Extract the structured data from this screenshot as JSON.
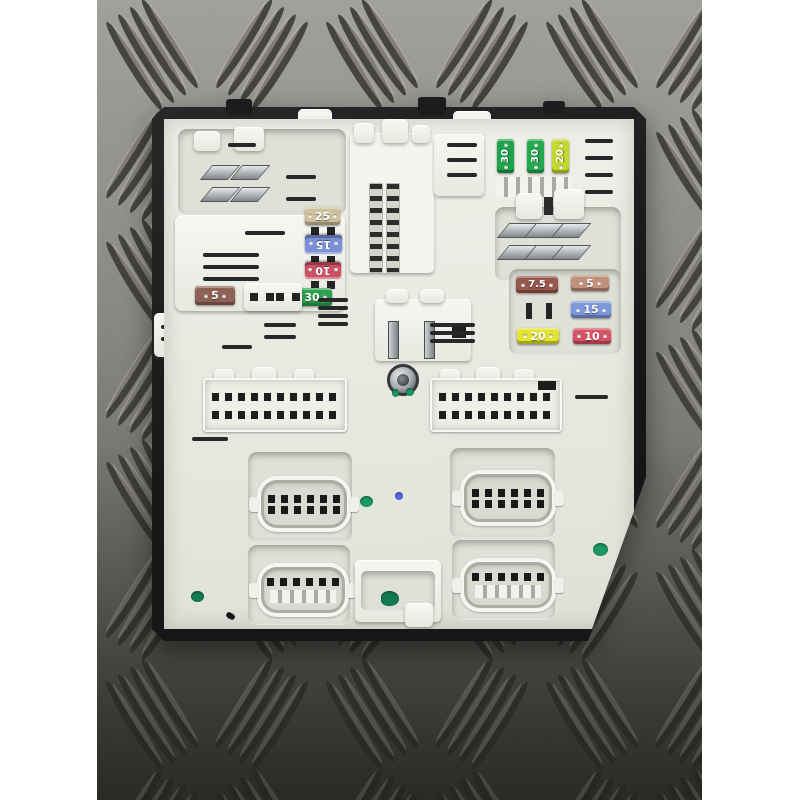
{
  "fuse_box": {
    "top_right_fuses": [
      {
        "label": "30",
        "color": "#1fa24c"
      },
      {
        "label": "30",
        "color": "#23a84f"
      },
      {
        "label": "20",
        "color": "#c3d92e"
      }
    ],
    "left_column_fuses": [
      {
        "label": "25",
        "color": "#cec09c"
      },
      {
        "label": "15",
        "color": "#7b90d6"
      },
      {
        "label": "10",
        "color": "#cc5064"
      },
      {
        "label": "30",
        "color": "#2da24e"
      }
    ],
    "left_single_fuse": {
      "label": "5",
      "color": "#8e6156"
    },
    "right_cluster_fuses": [
      {
        "label": "7.5",
        "color": "#98574d"
      },
      {
        "label": "5",
        "color": "#c09179"
      },
      {
        "label": "15",
        "color": "#7f97dc"
      },
      {
        "label": "20",
        "color": "#e3e432"
      },
      {
        "label": "10",
        "color": "#d85266"
      }
    ],
    "paint_marks": {
      "green": "#1c9a62",
      "dark_green": "#127a50",
      "blue": "#5a6be0",
      "black": "#17191a"
    }
  }
}
